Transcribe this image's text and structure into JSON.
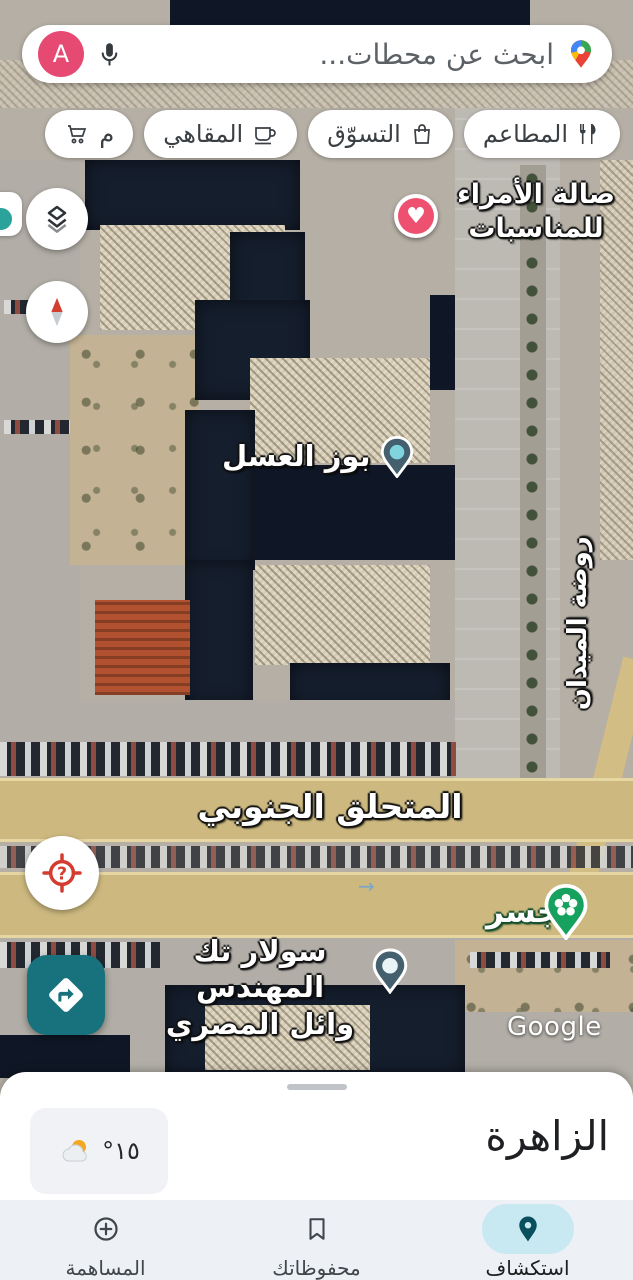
{
  "search": {
    "query": "ابحث عن محطات...",
    "avatar_letter": "A",
    "avatar_color": "#e64a73",
    "logo_icon": "google-maps-pin-icon",
    "mic_icon": "microphone-icon"
  },
  "chips": [
    {
      "label": "المطاعم",
      "icon": "restaurants-icon"
    },
    {
      "label": "التسوّق",
      "icon": "shopping-bag-icon"
    },
    {
      "label": "المقاهي",
      "icon": "coffee-cup-icon"
    },
    {
      "label": "م",
      "icon": "grocery-cart-icon",
      "partial": true
    }
  ],
  "map_controls": {
    "layers": "layers-button",
    "compass": "compass-button",
    "locate": "my-location-button",
    "directions": "directions-fab"
  },
  "map": {
    "poi_hall_line1": "صالة الأمراء",
    "poi_hall_line2": "للمناسبات",
    "poi_honey": "بوز العسل",
    "street_vertical": "روضة الميدان",
    "highway": "المتحلق الجنوبي",
    "poi_bridge": "جسر",
    "poi_solar_line1": "سولار تك المهندس",
    "poi_solar_line2": "وائل المصري",
    "watermark": "Google"
  },
  "bottom_sheet": {
    "title": "الزاهرة",
    "temperature": "°١٥",
    "weather_icon": "sun-behind-cloud-icon"
  },
  "bottom_nav": {
    "explore": "استكشاف",
    "saved": "محفوظاتك",
    "contribute": "المساهمة",
    "active_pill_color": "#c8e9f2",
    "active_icon_color": "#09505c"
  },
  "colors": {
    "road_band": "#cdb97f",
    "directions_fab": "#17727e",
    "heart_pin": "#ee5170",
    "park_pin": "#16a15e",
    "nav_background": "#edf1f6"
  }
}
